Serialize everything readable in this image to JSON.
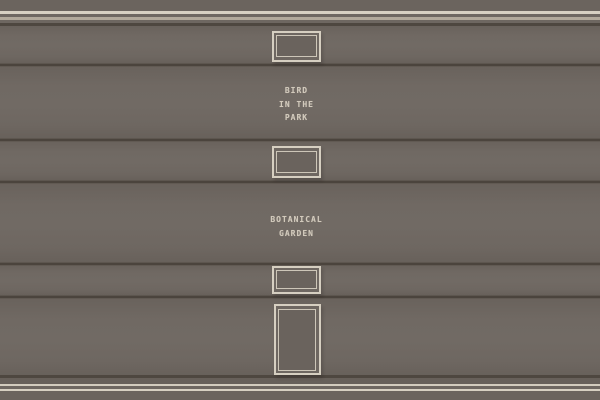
{
  "scene": {
    "description": "gallery-wall-with-picture-frames",
    "labels": {
      "bird": {
        "lines": [
          "BIRD",
          "IN THE",
          "PARK"
        ]
      },
      "garden": {
        "lines": [
          "BOTANICAL",
          "GARDEN"
        ]
      }
    },
    "frames": [
      {
        "name": "small-landscape-frame-top"
      },
      {
        "name": "small-landscape-frame-middle"
      },
      {
        "name": "small-landscape-frame-lower"
      },
      {
        "name": "tall-portrait-frame-bottom"
      }
    ],
    "colors": {
      "wall": "#6e6761",
      "panel_shade": "#69625c",
      "molding_bright": "#d7d0c2",
      "molding_tan": "#b2a99b",
      "molding_dark": "#4e4740",
      "divider": "#4b443d",
      "frame_border": "#d6cfc1",
      "frame_interior": "#6a635d",
      "label_text": "#d2cabc"
    }
  }
}
